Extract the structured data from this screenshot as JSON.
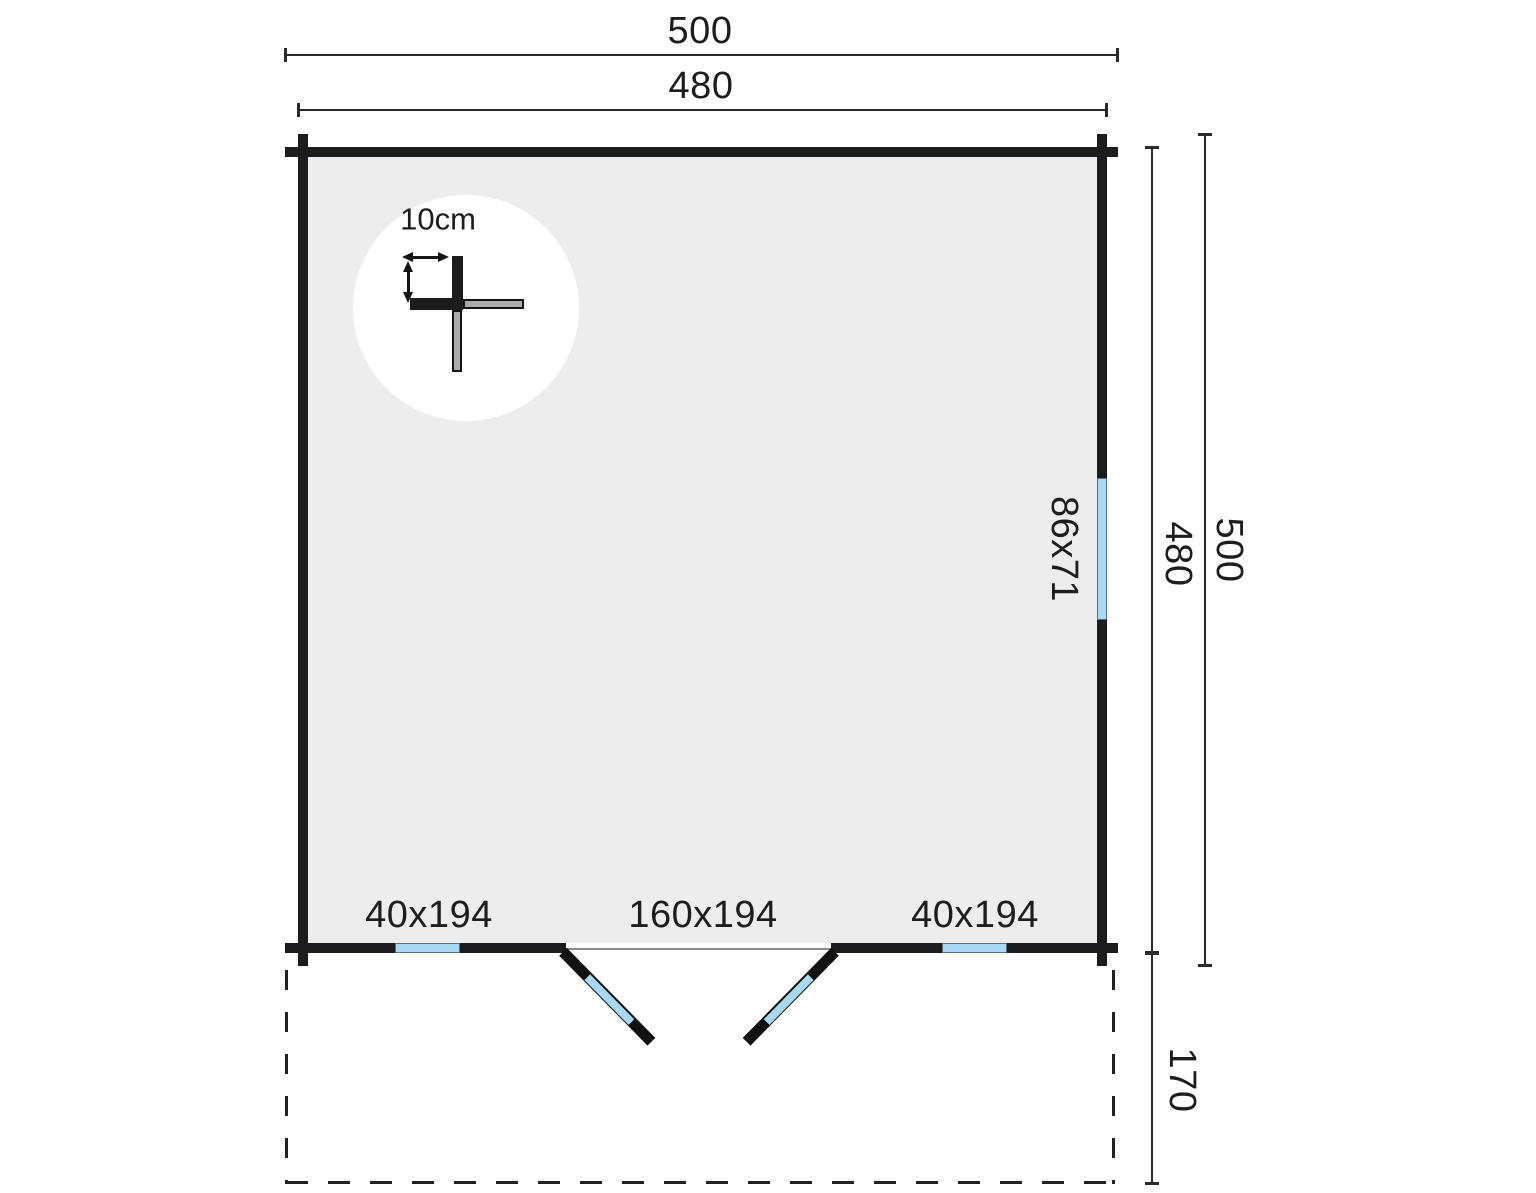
{
  "labels": {
    "dim_top_outer": "500",
    "dim_top_inner": "480",
    "dim_right_inner": "480",
    "dim_right_outer": "500",
    "dim_terrace_depth": "170",
    "detail_thickness": "10cm",
    "window_right": "86x71",
    "window_bottom_left": "40x194",
    "door": "160x194",
    "window_bottom_right": "40x194"
  },
  "colors": {
    "wall": "#1c1c1e",
    "interior": "#ededee",
    "glass": "#a9d9f2",
    "log_end": "#a9aaac",
    "dimension_line": "#2a2a2a",
    "background": "#ffffff"
  }
}
